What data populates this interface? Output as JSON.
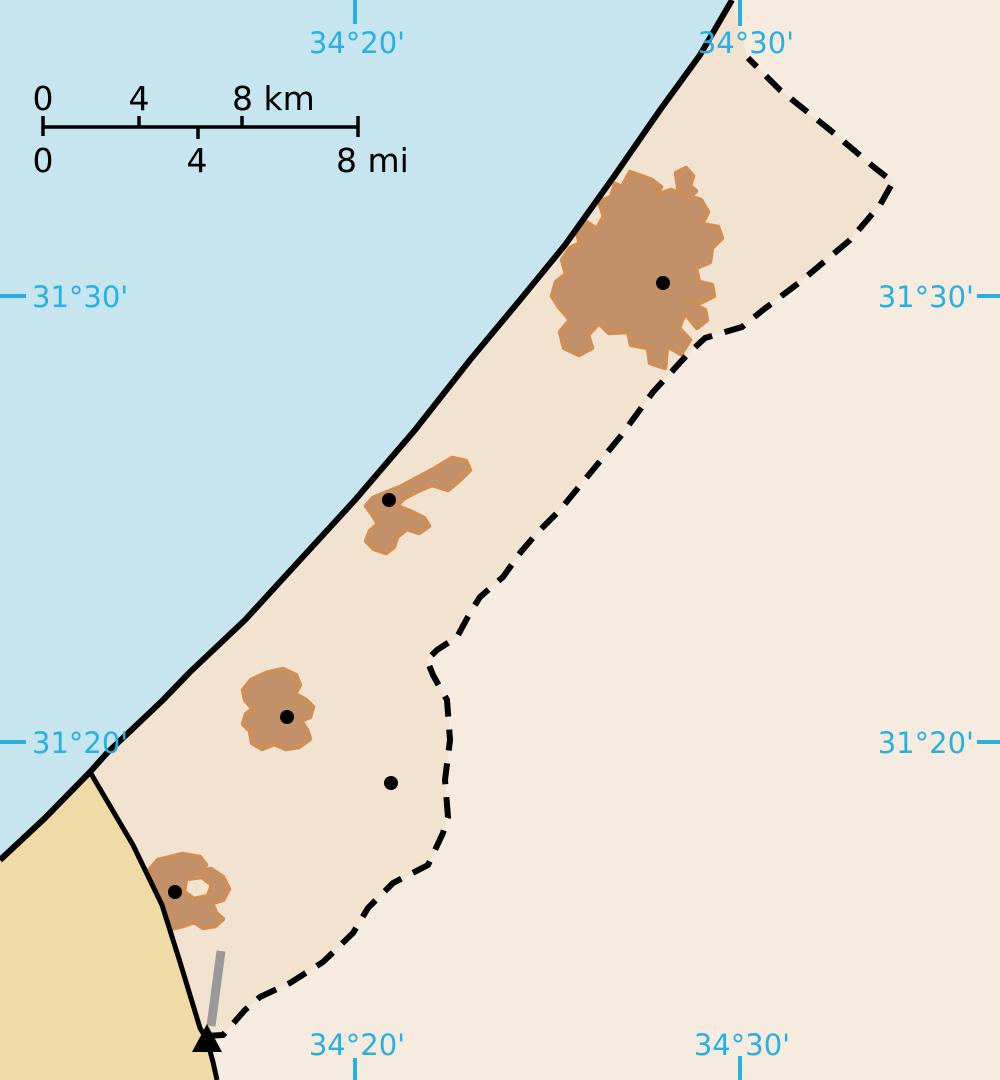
{
  "map": {
    "region": "Gaza Strip",
    "colors": {
      "sea": "#c6e5ee",
      "gaza_strip_land": "#f2e3d1",
      "israel_land": "#f5ecdf",
      "egypt_land": "#f0dba6",
      "urban_fill": "#c39169",
      "urban_stroke": "#cd8f57",
      "border_line": "#000000",
      "graticule": "#29b0e2",
      "runway_gray": "#999999"
    },
    "graticule": {
      "lon_34_20": "34°20'",
      "lon_34_30": "34°30'",
      "lat_31_30": "31°30'",
      "lat_31_20": "31°20'"
    },
    "scalebar": {
      "km": {
        "t0": "0",
        "t4": "4",
        "t8": "8 km"
      },
      "mi": {
        "t0": "0",
        "t4": "4",
        "t8": "8 mi"
      }
    },
    "markers": {
      "city_dot_count": 5,
      "peak_marker": "triangle-marker",
      "runway": "airport-runway"
    }
  }
}
